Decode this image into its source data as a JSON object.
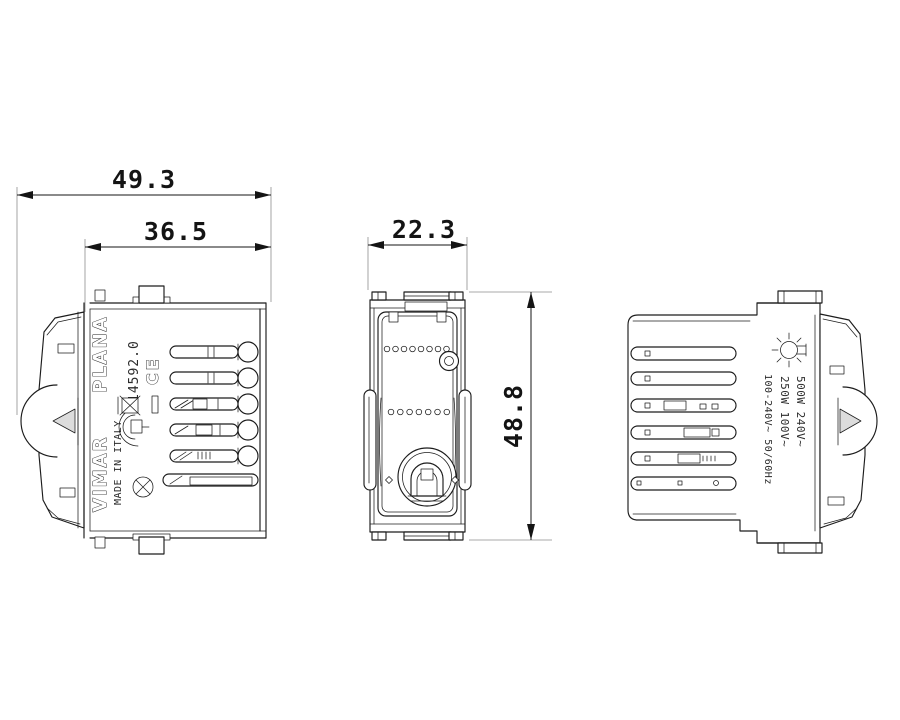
{
  "drawing": {
    "background_color": "#ffffff",
    "line_color": "#1c1c1c",
    "dimension_color": "#141414",
    "dimensions_mm": {
      "overall_depth": "49.3",
      "body_depth": "36.5",
      "module_width": "22.3",
      "module_height": "48.8"
    },
    "views": {
      "left_side_view": {
        "brand": "VIMAR",
        "series": "PLANA",
        "model_number": "14592.0",
        "origin_text": "MADE IN ITALY",
        "ce_mark": "CE",
        "icons": [
          "screw-head-icon",
          "imq-quality-mark-icon",
          "weee-crossed-bin-icon",
          "minus-bar-icon"
        ]
      },
      "front_view": {
        "features": [
          "mounting-tabs",
          "ventilation-holes",
          "potentiometer",
          "screw-terminal",
          "side-clips"
        ]
      },
      "right_side_view": {
        "rating_line_1": "500W 240V~",
        "rating_line_2": "250W 100V~",
        "rating_line_3": "100-240V~ 50/60Hz",
        "icons": [
          "incandescent-lamp-icon"
        ]
      }
    }
  }
}
